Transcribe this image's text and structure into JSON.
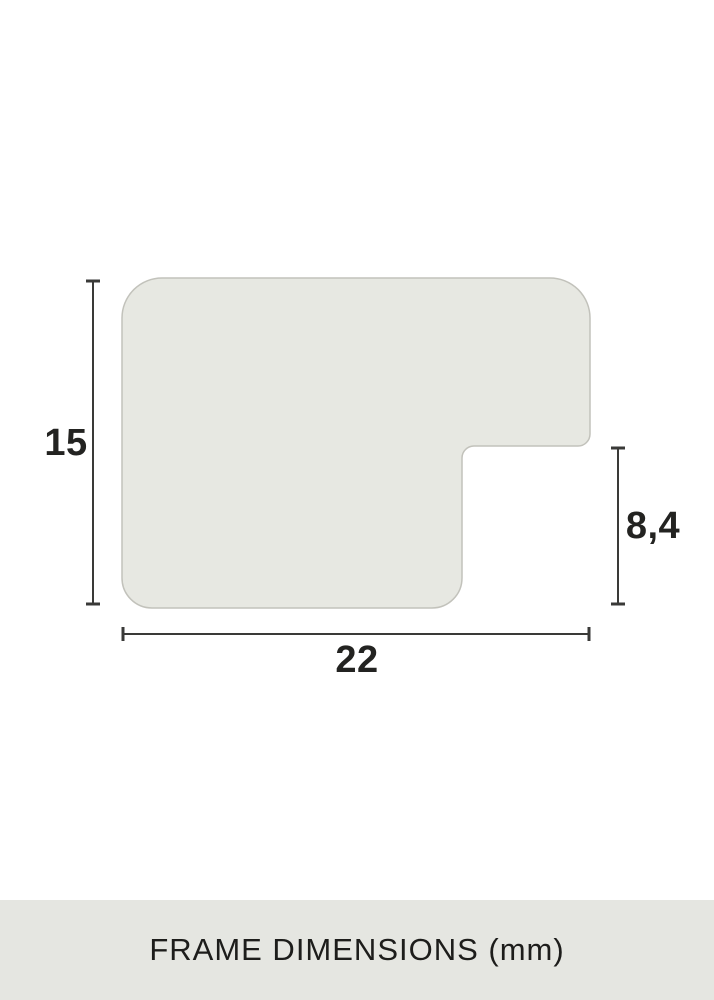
{
  "diagram": {
    "type": "frame-moulding-profile-cross-section",
    "dimensions_mm": {
      "height": "15",
      "width": "22",
      "rabbet_height": "8,4"
    },
    "labels": {
      "height_label": "15",
      "width_label": "22",
      "rabbet_label": "8,4"
    },
    "colors": {
      "shape_fill": "#e7e8e2",
      "shape_border": "#c2c2bb",
      "dimension_line": "#3a3a38",
      "label_text": "#232321"
    }
  },
  "footer": {
    "caption": "FRAME DIMENSIONS (mm)",
    "background": "#e5e6e1",
    "text_color": "#1d1d1b"
  }
}
